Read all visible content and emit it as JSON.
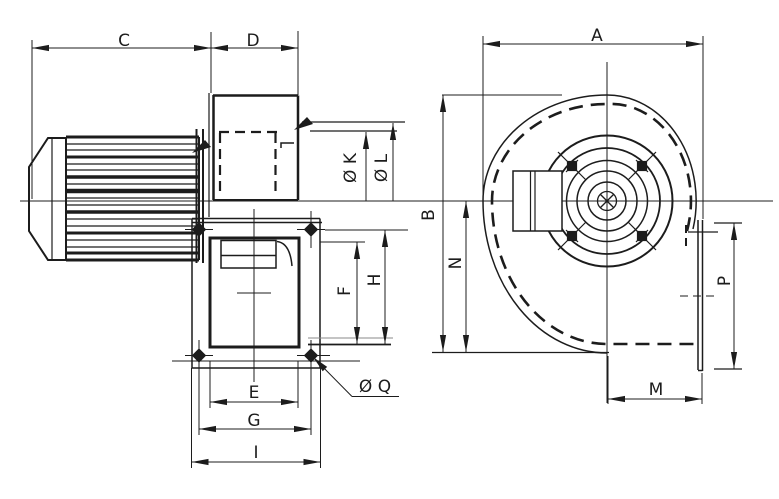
{
  "drawing": {
    "kind": "dimensional line drawing",
    "views": [
      "side view with motor",
      "front view of scroll housing"
    ]
  },
  "labels": {
    "C": "C",
    "D": "D",
    "A": "A",
    "diaK": "Ø K",
    "diaL": "Ø L",
    "B": "B",
    "N": "N",
    "F": "F",
    "H": "H",
    "E": "E",
    "G": "G",
    "I": "I",
    "diaQ": "Ø Q",
    "M": "M",
    "P": "P"
  },
  "colors": {
    "ink": "#1c1c1c",
    "faint": "#8a8a8a",
    "background": "#ffffff"
  }
}
